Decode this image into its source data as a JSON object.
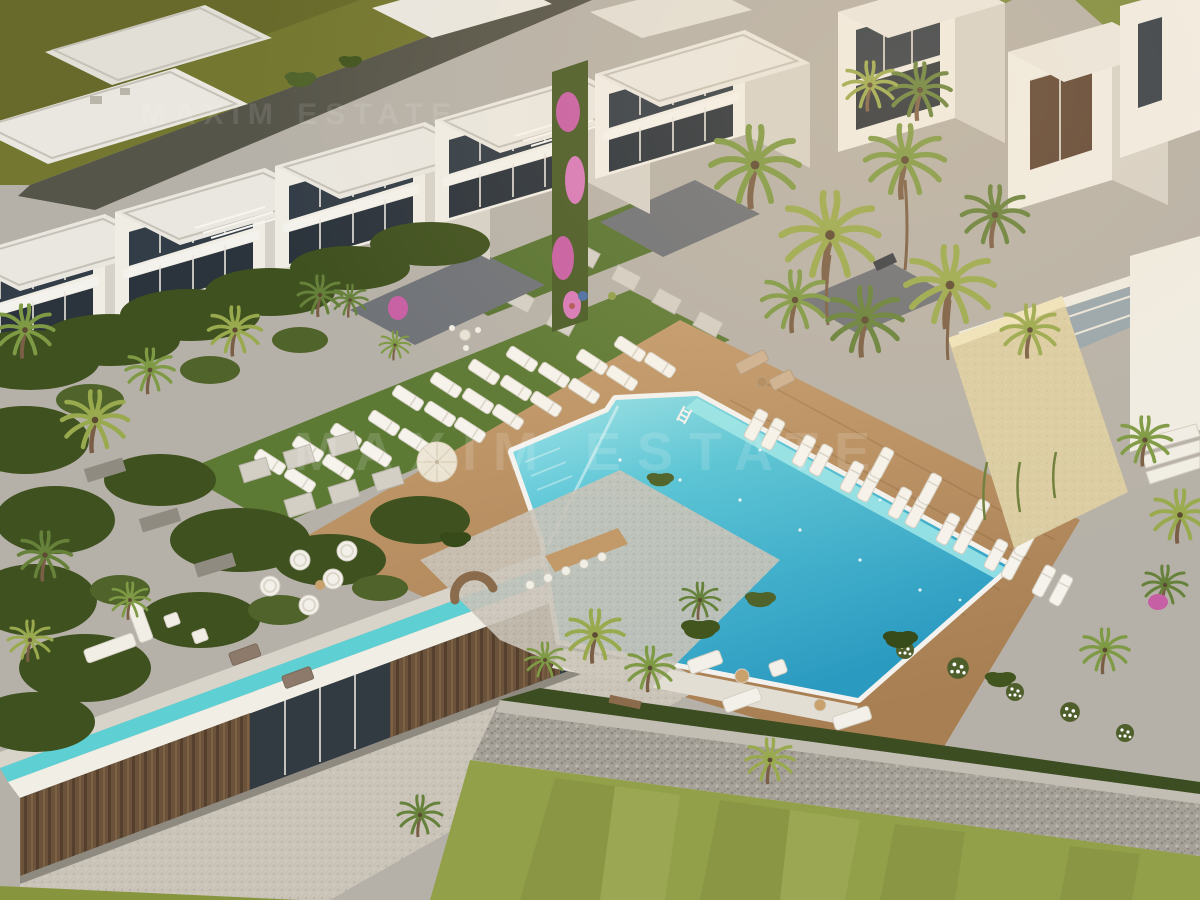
{
  "scene": {
    "description": "Aerial 3D architectural rendering of a modern white resort-style residential complex at golden hour: rows of flat-roofed townhouses, a large turquoise swimming pool with sun loungers on a timber deck, tropical gardens with palm trees, a clubhouse with an infinity water channel, stone walls and lawns",
    "watermark": {
      "text": "MAXIM ESTATE"
    },
    "colors": {
      "pool_water": "#3fb3cf",
      "pool_shallow": "#9fe7ea",
      "pool_deck": "#b98e60",
      "buildings_white": "#efece3",
      "building_shadow": "#d2cec5",
      "window_glass": "#333d47",
      "stone_wall_beige": "#dbcda3",
      "paving_gray": "#b6b1a8",
      "gabion_stone": "#a6a198",
      "water_channel": "#5ecfd2",
      "wood_slats": "#7a5c40",
      "gravel": "#c9c3b8",
      "lawn_green": "#93a04a",
      "field_olive": "#73772f",
      "garden_green": "#42551f",
      "palm_green": "#7e9a45",
      "bougainvillea_pink": "#c75fa4",
      "lounger_white": "#f6f3ec"
    }
  }
}
